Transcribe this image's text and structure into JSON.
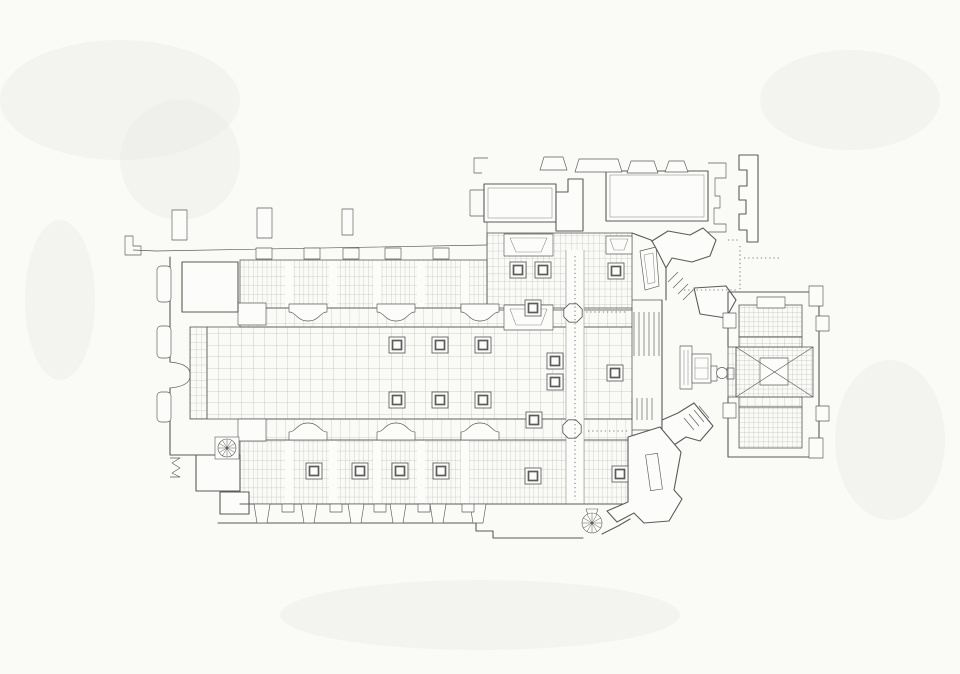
{
  "canvas": {
    "width": 960,
    "height": 674
  },
  "colors": {
    "paper": "#fafaf7",
    "ink": "#5b5b5b",
    "ink_light": "#8a8a8a",
    "grid": "#a6a6a6",
    "white": "#fcfcfa"
  },
  "plan": {
    "piers": [
      [
        397,
        345
      ],
      [
        440,
        345
      ],
      [
        483,
        345
      ],
      [
        397,
        400
      ],
      [
        440,
        400
      ],
      [
        483,
        400
      ],
      [
        518,
        270
      ],
      [
        543,
        270
      ],
      [
        616,
        271
      ],
      [
        533,
        308
      ],
      [
        555,
        361
      ],
      [
        555,
        382
      ],
      [
        534,
        420
      ],
      [
        615,
        373
      ],
      [
        314,
        471
      ],
      [
        360,
        471
      ],
      [
        400,
        471
      ],
      [
        441,
        471
      ],
      [
        533,
        476
      ],
      [
        620,
        474
      ]
    ],
    "crossing_piers": [
      [
        573,
        313,
        10
      ],
      [
        572,
        429,
        10
      ]
    ],
    "spiral_stairs": [
      {
        "cx": 227,
        "cy": 448,
        "r": 9,
        "style": "square"
      },
      {
        "cx": 592,
        "cy": 523,
        "r": 10,
        "style": "teardrop"
      }
    ],
    "gravestones": [
      [
        172,
        210,
        15,
        30
      ],
      [
        257,
        208,
        15,
        30
      ],
      [
        342,
        209,
        11,
        26
      ]
    ],
    "north_windows_x": [
      264,
      312,
      351,
      393,
      441
    ],
    "south_windows_x": [
      288,
      336,
      380,
      424,
      468
    ],
    "aisle_bay_strips_x": [
      289,
      333,
      377,
      421,
      465
    ],
    "south_buttresses_x": [
      262,
      309,
      356,
      398,
      438,
      478
    ],
    "responds_x": [
      308,
      396,
      480
    ],
    "vestry_buttresses": [
      [
        540,
        157,
        27,
        13
      ],
      [
        575,
        159,
        47,
        13
      ],
      [
        627,
        161,
        31,
        12
      ],
      [
        665,
        161,
        23,
        11
      ]
    ],
    "chancel_steps": {
      "upper": {
        "x0": 634,
        "dx": 5,
        "n": 6,
        "y0": 312,
        "y1": 356
      },
      "lower": {
        "x0": 632,
        "dx": 5,
        "n": 5,
        "y0": 398,
        "y1": 420
      }
    },
    "ne_steps": [
      [
        668,
        282,
        678,
        272
      ],
      [
        673,
        288,
        683,
        278
      ],
      [
        678,
        294,
        688,
        284
      ],
      [
        683,
        300,
        693,
        290
      ]
    ],
    "se_steps": [
      [
        694,
        410,
        704,
        422
      ],
      [
        689,
        414,
        699,
        426
      ],
      [
        684,
        418,
        694,
        430
      ],
      [
        699,
        406,
        709,
        418
      ]
    ],
    "dotted_lines": [
      [
        575,
        256,
        575,
        500
      ],
      [
        740,
        246,
        740,
        290
      ],
      [
        684,
        290,
        736,
        290
      ],
      [
        744,
        258,
        779,
        258
      ],
      [
        588,
        431,
        628,
        431
      ],
      [
        728,
        240,
        738,
        240
      ],
      [
        586,
        312,
        626,
        312
      ]
    ]
  }
}
